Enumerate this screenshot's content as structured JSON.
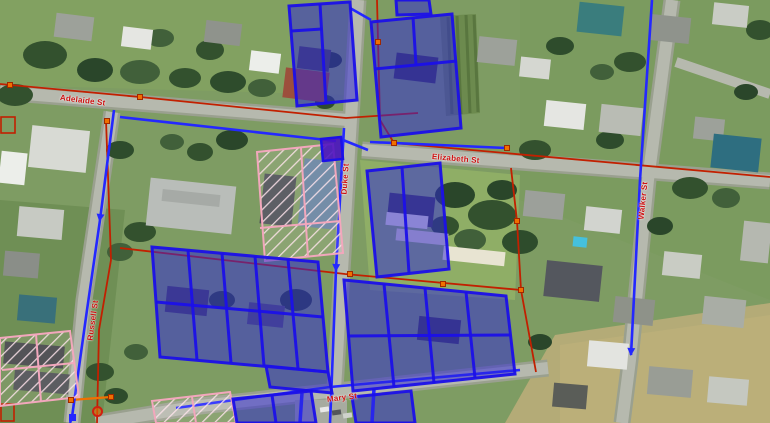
{
  "map": {
    "description": "Aerial imagery with cadastral boundaries, utility network lines, blue zoning parcels and pink heritage-hatched parcels",
    "street_labels": [
      {
        "id": "adelaide",
        "text": "Adelaide St",
        "x": 60,
        "y": 93,
        "rotation": 7
      },
      {
        "id": "duke",
        "text": "Duke St",
        "x": 344,
        "y": 190,
        "rotation": -86
      },
      {
        "id": "elizabeth",
        "text": "Elizabeth St",
        "x": 432,
        "y": 152,
        "rotation": 5
      },
      {
        "id": "walker",
        "text": "Walker St",
        "x": 641,
        "y": 215,
        "rotation": -84
      },
      {
        "id": "russell",
        "text": "Russell St",
        "x": 90,
        "y": 336,
        "rotation": -82
      },
      {
        "id": "mary",
        "text": "Mary St",
        "x": 327,
        "y": 395,
        "rotation": -7
      }
    ],
    "colors": {
      "zoning_fill": "#2b24d8",
      "zoning_stroke": "#1b10e8",
      "solid_parcel_purple": "#4a10c2",
      "cadastre_red": "#c22000",
      "node_orange": "#f07000",
      "network_blue": "#2428ff",
      "heritage_pink": "#f2a7bc",
      "label_red": "#cc1111"
    },
    "markers": {
      "orange_squares": [
        [
          10,
          85
        ],
        [
          140,
          97
        ],
        [
          107,
          121
        ],
        [
          378,
          42
        ],
        [
          394,
          143
        ],
        [
          507,
          148
        ],
        [
          517,
          221
        ],
        [
          350,
          274
        ],
        [
          443,
          284
        ],
        [
          521,
          290
        ],
        [
          71,
          400
        ],
        [
          111,
          397
        ]
      ],
      "blue_squares": [
        [
          72,
          417
        ]
      ],
      "red_circles": [
        [
          97,
          411
        ]
      ]
    }
  }
}
